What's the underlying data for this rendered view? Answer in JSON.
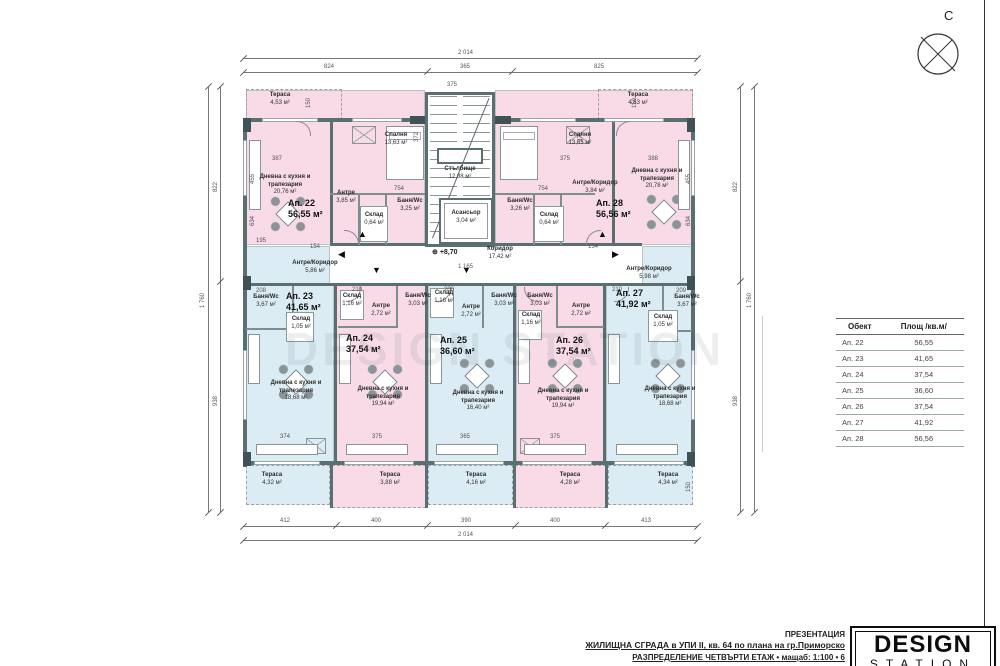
{
  "sheet": {
    "compass_label": "С",
    "watermark": "DESIGN STATION",
    "floor_level": "+8,70",
    "level_icon": "⊕"
  },
  "title_block": {
    "presentation": "ПРЕЗЕНТАЦИЯ",
    "project": "ЖИЛИЩНА СГРАДА в УПИ II, кв. 64 по плана на гр.Приморско",
    "sheet_name": "РАЗПРЕДЕЛЕНИЕ ЧЕТВЪРТИ ЕТАЖ • мащаб: 1:100 • 6",
    "logo_top": "DESIGN",
    "logo_bottom": "STATION"
  },
  "area_table": {
    "headers": [
      "Обект",
      "Площ /кв.м/"
    ],
    "rows": [
      {
        "obj": "Ап. 22",
        "area": "56,55"
      },
      {
        "obj": "Ап. 23",
        "area": "41,65"
      },
      {
        "obj": "Ап. 24",
        "area": "37,54"
      },
      {
        "obj": "Ап. 25",
        "area": "36,60"
      },
      {
        "obj": "Ап. 26",
        "area": "37,54"
      },
      {
        "obj": "Ап. 27",
        "area": "41,92"
      },
      {
        "obj": "Ап. 28",
        "area": "56,56"
      }
    ]
  },
  "apartments": {
    "ap22": {
      "label": "Ап. 22",
      "area": "56,55 м²"
    },
    "ap23": {
      "label": "Ап. 23",
      "area": "41,65 м²"
    },
    "ap24": {
      "label": "Ап. 24",
      "area": "37,54 м²"
    },
    "ap25": {
      "label": "Ап. 25",
      "area": "36,60 м²"
    },
    "ap26": {
      "label": "Ап. 26",
      "area": "37,54 м²"
    },
    "ap27": {
      "label": "Ап. 27",
      "area": "41,92 м²"
    },
    "ap28": {
      "label": "Ап. 28",
      "area": "56,56 м²"
    }
  },
  "rooms": {
    "ter22": {
      "name": "Тераса",
      "area": "4,53 м²"
    },
    "bed22": {
      "name": "Спалня",
      "area": "13,63 м²"
    },
    "liv22": {
      "name": "Дневна с кухня и трапезария",
      "area": "20,76 м²"
    },
    "ant22": {
      "name": "Антре",
      "area": "3,85 м²"
    },
    "bath22": {
      "name": "Баня/Wc",
      "area": "3,25 м²"
    },
    "stor22": {
      "name": "Склад",
      "area": "0,64 м²"
    },
    "stairs": {
      "name": "Стълбище",
      "area": "12,88 м²"
    },
    "elevator": {
      "name": "Асансьор",
      "area": "3,04 м²"
    },
    "corridor": {
      "name": "Коридор",
      "area": "17,42 м²"
    },
    "ter28": {
      "name": "Тераса",
      "area": "4,53 м²"
    },
    "bed28": {
      "name": "Спалня",
      "area": "13,63 м²"
    },
    "liv28": {
      "name": "Дневна с кухня и трапезария",
      "area": "20,78 м²"
    },
    "ant28": {
      "name": "Антре/Коридор",
      "area": "3,84 м²"
    },
    "bath28": {
      "name": "Баня/Wc",
      "area": "3,26 м²"
    },
    "stor28": {
      "name": "Склад",
      "area": "0,64 м²"
    },
    "ant23": {
      "name": "Антре/Коридор",
      "area": "5,86 м²"
    },
    "bath23": {
      "name": "Баня/Wc",
      "area": "3,67 м²"
    },
    "stor23": {
      "name": "Склад",
      "area": "1,05 м²"
    },
    "liv23": {
      "name": "Дневна с кухня и трапезария",
      "area": "18,68 м²"
    },
    "ter23": {
      "name": "Тераса",
      "area": "4,32 м²"
    },
    "ant24": {
      "name": "Антре",
      "area": "2,72 м²"
    },
    "bath24": {
      "name": "Баня/Wc",
      "area": "3,03 м²"
    },
    "stor24": {
      "name": "Склад",
      "area": "1,16 м²"
    },
    "liv24": {
      "name": "Дневна с кухня и трапезария",
      "area": "19,94 м²"
    },
    "ter24": {
      "name": "Тераса",
      "area": "3,88 м²"
    },
    "ant25": {
      "name": "Антре",
      "area": "2,72 м²"
    },
    "bath25": {
      "name": "Баня/Wc",
      "area": "3,03 м²"
    },
    "stor25": {
      "name": "Склад",
      "area": "1,16 м²"
    },
    "liv25": {
      "name": "Дневна с кухня и трапезария",
      "area": "16,40 м²"
    },
    "ter25": {
      "name": "Тераса",
      "area": "4,16 м²"
    },
    "ant26": {
      "name": "Антре",
      "area": "2,72 м²"
    },
    "bath26": {
      "name": "Баня/Wc",
      "area": "3,03 м²"
    },
    "stor26": {
      "name": "Склад",
      "area": "1,16 м²"
    },
    "liv26": {
      "name": "Дневна с кухня и трапезария",
      "area": "19,94 м²"
    },
    "ter26": {
      "name": "Тераса",
      "area": "4,28 м²"
    },
    "ant27": {
      "name": "Антре/Коридор",
      "area": "5,98 м²"
    },
    "bath27": {
      "name": "Баня/Wc",
      "area": "3,67 м²"
    },
    "stor27": {
      "name": "Склад",
      "area": "1,05 м²"
    },
    "liv27": {
      "name": "Дневна с кухня и трапезария",
      "area": "18,68 м²"
    },
    "ter27": {
      "name": "Тераса",
      "area": "4,34 м²"
    }
  },
  "dims": {
    "top_total": "2 014",
    "top": [
      "824",
      "365",
      "825"
    ],
    "bottom": [
      "412",
      "400",
      "390",
      "400",
      "413"
    ],
    "bottom_total": "2 014",
    "left": [
      "822",
      "938"
    ],
    "left_total": "1 760",
    "right": [
      "822",
      "938"
    ],
    "right_total": "1 760",
    "inner": [
      "387",
      "375",
      "372",
      "372",
      "375",
      "388",
      "455",
      "634",
      "455",
      "634",
      "754",
      "754",
      "195",
      "154",
      "154",
      "1 165",
      "208",
      "210",
      "200",
      "210",
      "209",
      "374",
      "375",
      "365",
      "375",
      "150",
      "150",
      "150"
    ]
  },
  "colors": {
    "room_pink": "#f9dbe7",
    "room_blue": "#dcecf4",
    "wall": "#5a6f72"
  }
}
